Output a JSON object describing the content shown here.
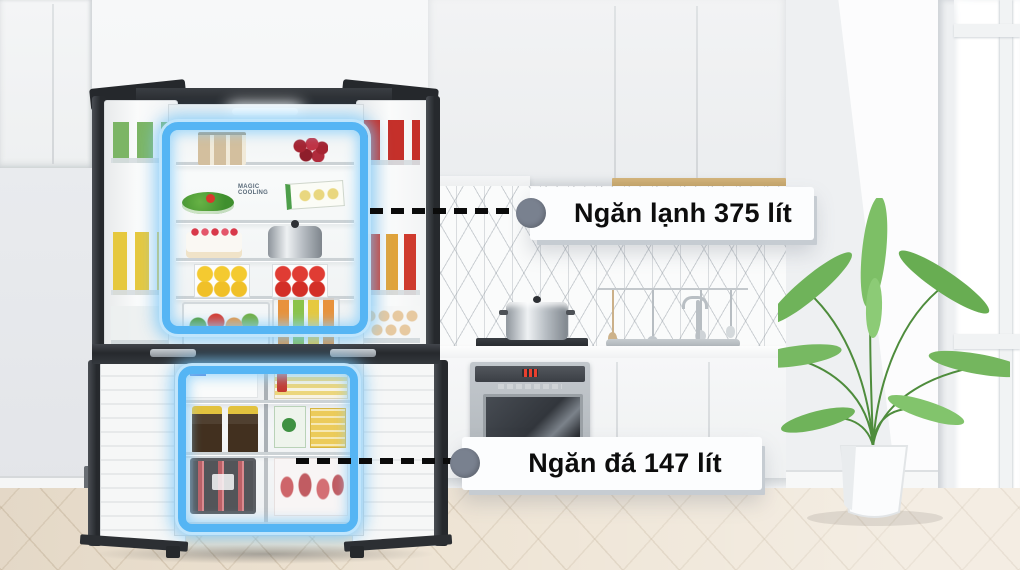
{
  "scene": {
    "subject": "four-door refrigerator open in a white kitchen",
    "callouts": [
      {
        "id": "fresh-compartment",
        "label": "Ngăn lạnh 375 lít"
      },
      {
        "id": "freezer-compartment",
        "label": "Ngăn đá 147 lít"
      }
    ],
    "fridge": {
      "interior_branding": "MAGIC COOLING"
    },
    "colors": {
      "glow_blue": "#55b5f4",
      "glow_halo": "#bfe6fc",
      "callout_dot": "#79818f",
      "dash_black": "#0b0b0b",
      "label_bg": "#fcfdfe",
      "label_text": "#0d0d0d",
      "fridge_body": "#26292d",
      "wood_trim": "#d3b47c"
    }
  }
}
